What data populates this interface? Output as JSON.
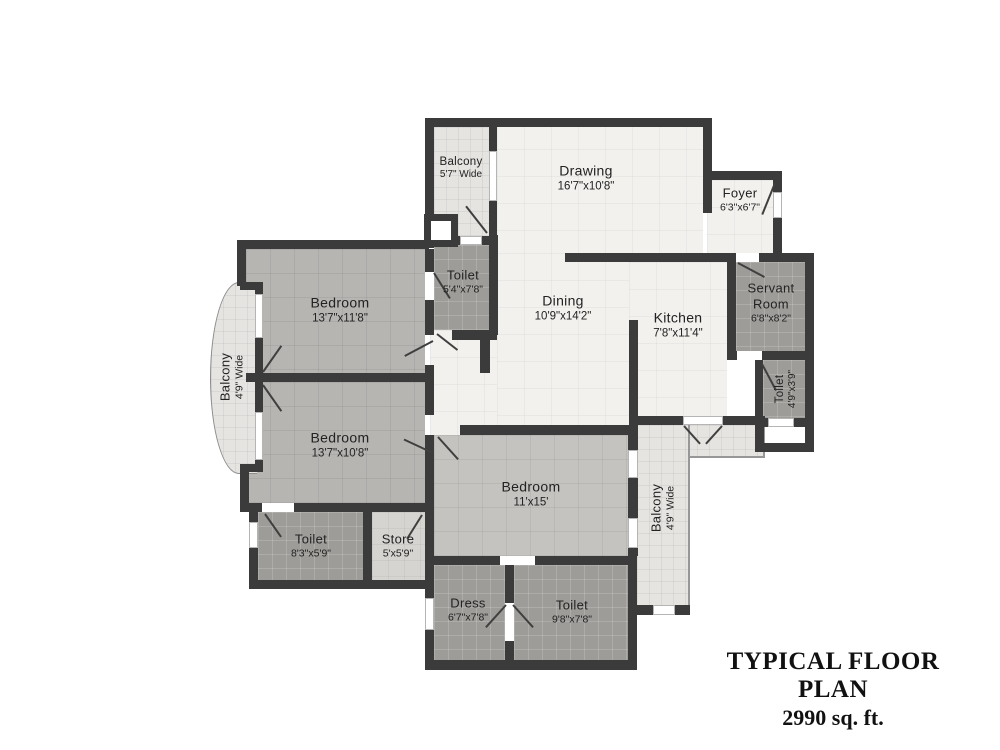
{
  "title": {
    "line1": "TYPICAL FLOOR PLAN",
    "line2": "2990 sq. ft."
  },
  "rooms": [
    {
      "id": "balcony-top",
      "name": "Balcony",
      "dims": "5'7\" Wide"
    },
    {
      "id": "drawing",
      "name": "Drawing",
      "dims": "16'7\"x10'8\""
    },
    {
      "id": "foyer",
      "name": "Foyer",
      "dims": "6'3\"x6'7\""
    },
    {
      "id": "toilet-top",
      "name": "Toilet",
      "dims": "5'4\"x7'8\""
    },
    {
      "id": "dining",
      "name": "Dining",
      "dims": "10'9\"x14'2\""
    },
    {
      "id": "kitchen",
      "name": "Kitchen",
      "dims": "7'8\"x11'4\""
    },
    {
      "id": "servant-room",
      "name": "Servant Room",
      "dims": "6'8\"x8'2\""
    },
    {
      "id": "toilet-servant",
      "name": "Toilet",
      "dims": "4'9\"x3'9\""
    },
    {
      "id": "bedroom-1",
      "name": "Bedroom",
      "dims": "13'7\"x11'8\""
    },
    {
      "id": "balcony-left",
      "name": "Balcony",
      "dims": "4'9\" Wide"
    },
    {
      "id": "bedroom-2",
      "name": "Bedroom",
      "dims": "13'7\"x10'8\""
    },
    {
      "id": "toilet-2",
      "name": "Toilet",
      "dims": "8'3\"x5'9\""
    },
    {
      "id": "store",
      "name": "Store",
      "dims": "5'x5'9\""
    },
    {
      "id": "bedroom-3",
      "name": "Bedroom",
      "dims": "11'x15'"
    },
    {
      "id": "balcony-right",
      "name": "Balcony",
      "dims": "4'9\" Wide"
    },
    {
      "id": "dress",
      "name": "Dress",
      "dims": "6'7\"x7'8\""
    },
    {
      "id": "toilet-3",
      "name": "Toilet",
      "dims": "9'8\"x7'8\""
    }
  ],
  "colors": {
    "wall": "#3b3b3b",
    "living_area": "#f3f1ee",
    "bedroom": "#b7b5b2",
    "wet_area": "#9e9c99",
    "balcony": "#e6e4e1",
    "store": "#d6d4d1",
    "text": "#222222"
  }
}
